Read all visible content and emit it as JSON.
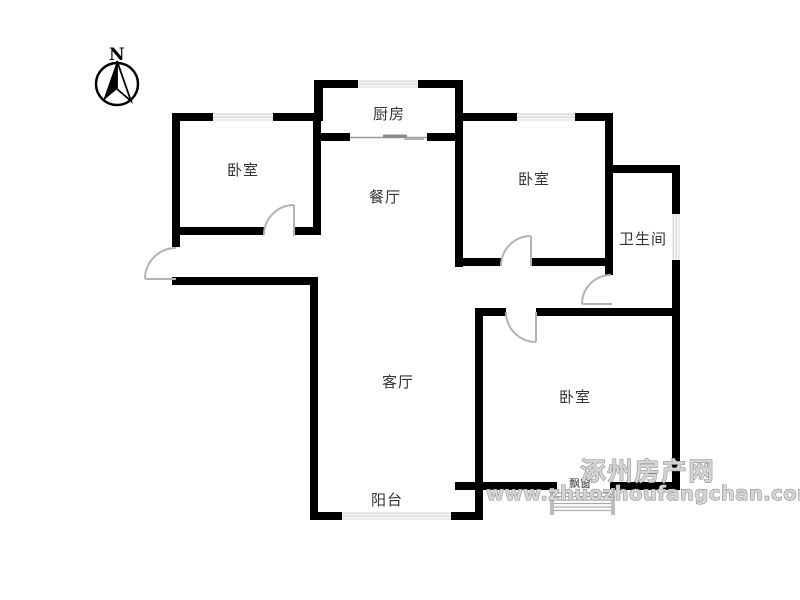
{
  "compass": {
    "label": "N"
  },
  "rooms": [
    {
      "id": "bedroom-top-left",
      "label": "卧室"
    },
    {
      "id": "kitchen",
      "label": "厨房"
    },
    {
      "id": "dining-room",
      "label": "餐厅"
    },
    {
      "id": "bedroom-top-right",
      "label": "卧室"
    },
    {
      "id": "bathroom",
      "label": "卫生间"
    },
    {
      "id": "living-room",
      "label": "客厅"
    },
    {
      "id": "bedroom-bottom",
      "label": "卧室"
    },
    {
      "id": "balcony",
      "label": "阳台"
    },
    {
      "id": "bay-window",
      "label": "飘窗"
    }
  ],
  "watermark": {
    "line1": "涿州房产网",
    "line2": "www.zhuozhoufangchan.com"
  },
  "colors": {
    "wall": "#000000",
    "door": "#b3b3b3",
    "window_fill": "#d9d9d9",
    "window_stripe": "#ffffff",
    "label": "#333333",
    "watermark_fill": "#d4d4d4",
    "watermark_stroke": "#878787"
  }
}
